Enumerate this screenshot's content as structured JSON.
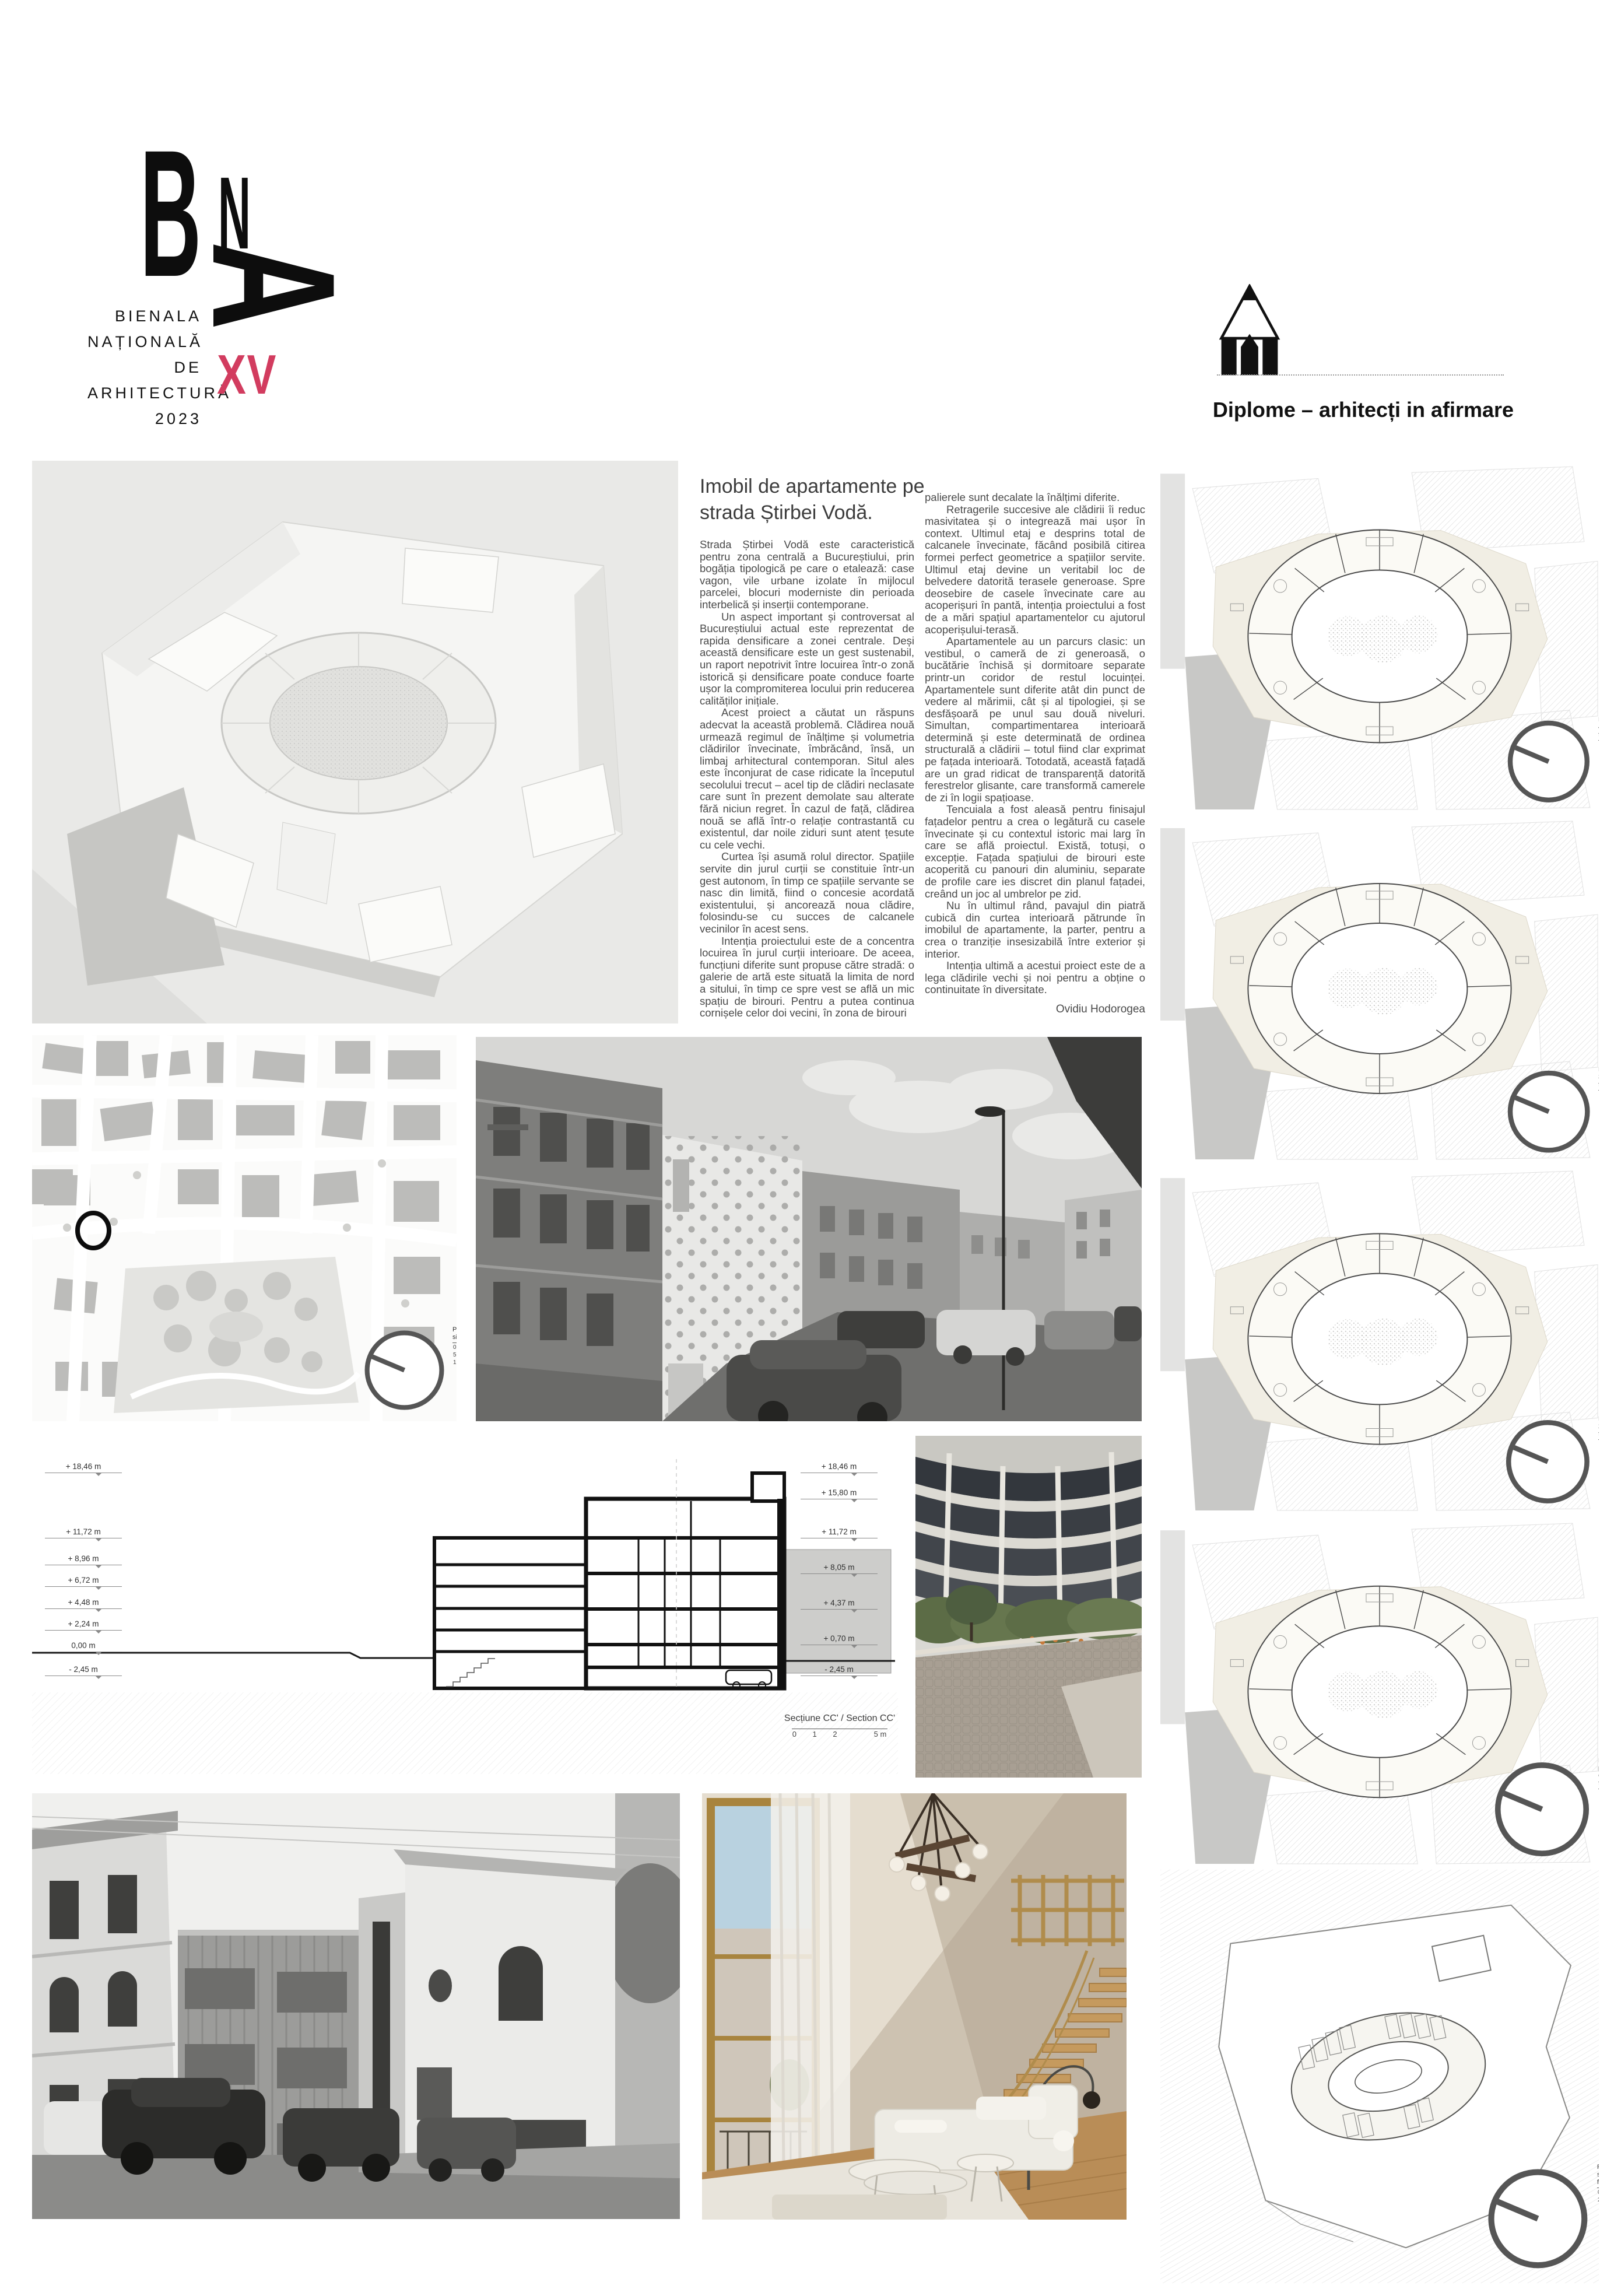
{
  "logo": {
    "letter_b": "B",
    "letter_n": "N",
    "letter_a": "A",
    "lines": [
      "BIENALA",
      "NAȚIONALĂ",
      "DE",
      "ARHITECTURĂ",
      "2023"
    ],
    "edition": "XV",
    "edition_color": "#d23c5f"
  },
  "category": {
    "label": "Diplome – arhitecți in afirmare",
    "icon": "pencil-icon"
  },
  "article": {
    "title": "Imobil de apartamente pe strada Știrbei Vodă.",
    "col1": [
      "Strada Știrbei Vodă este caracteristică pentru zona centrală a Bucureștiului, prin bogăția tipologică pe care o etalează: case vagon, vile urbane izolate în mijlocul parcelei, blocuri moderniste din perioada interbelică și inserții contemporane.",
      "Un aspect important și controversat al Bucureștiului actual este reprezentat de rapida densificare a zonei centrale. Deși această densificare este un gest sustenabil, un raport nepotrivit între locuirea într-o zonă istorică și densificare poate conduce foarte ușor la compromiterea locului prin reducerea calităților inițiale.",
      "Acest proiect a căutat un răspuns adecvat la această problemă. Clădirea nouă urmează regimul de înălțime și volumetria clădirilor învecinate, îmbrăcând, însă, un limbaj arhitectural contemporan. Situl ales este înconjurat de case ridicate la începutul secolului trecut – acel tip de clădiri neclasate care sunt în prezent demolate sau alterate fără niciun regret. În cazul de față, clădirea nouă se află într-o relație contrastantă cu existentul, dar noile ziduri sunt atent țesute cu cele vechi.",
      "Curtea își asumă rolul director. Spațiile servite din jurul curții se constituie într-un gest autonom, în timp ce spațiile servante se nasc din limită, fiind o concesie acordată existentului, și ancorează noua clădire, folosindu-se cu succes de calcanele vecinilor în acest sens.",
      "Intenția proiectului este de a concentra locuirea în jurul curții interioare. De aceea, funcțiuni diferite sunt propuse către stradă: o galerie de artă este situată la limita de nord a sitului, în timp ce spre vest se află un mic spațiu de birouri. Pentru a putea continua cornișele celor doi vecini, în zona de birouri"
    ],
    "col2": [
      "palierele sunt decalate la înălțimi diferite.",
      "Retragerile succesive ale clădirii îi reduc masivitatea și o integrează mai ușor în context. Ultimul etaj e desprins total de calcanele învecinate, făcând posibilă citirea formei perfect geometrice a spațiilor servite. Ultimul etaj devine un veritabil loc de belvedere datorită terasele generoase. Spre deosebire de casele învecinate care au acoperișuri în pantă, intenția proiectului a fost de a mări spațiul apartamentelor cu ajutorul acoperișului-terasă.",
      "Apartamentele au un parcurs clasic: un vestibul, o cameră de zi generoasă, o bucătărie închisă și dormitoare separate printr-un coridor de restul locuinței. Apartamentele sunt diferite atât din punct de vedere al mărimii, cât și al tipologiei, și se desfășoară pe unul sau două niveluri. Simultan, compartimentarea interioară determină și este determinată de ordinea structurală a clădirii – totul fiind clar exprimat pe fațada interioară. Totodată, această fațadă are un grad ridicat de transparență datorită ferestrelor glisante, care transformă camerele de zi în logii spațioase.",
      "Tencuiala a fost aleasă pentru finisajul fațadelor pentru a crea o legătură cu casele învecinate și cu contextul istoric mai larg în care se află proiectul. Există, totuși, o excepție. Fațada spațiului de birouri este acoperită cu panouri din aluminiu, separate de profile care ies discret din planul fațadei, creând un joc al umbrelor pe zid.",
      "Nu în ultimul rând, pavajul din piatră cubică din curtea interioară pătrunde în imobilul de apartamente, la parter, pentru a crea o tranziție insesizabilă între exterior și interior.",
      "Intenția ultimă a acestui proiect este de a lega clădirile vechi și noi pentru a obține o continuitate în diversitate."
    ],
    "author": "Ovidiu Hodorogea"
  },
  "section": {
    "caption": "Secțiune CC' / Section CC'",
    "scale_numbers": "0 1 2",
    "scale_end": "5 m",
    "levels_left": [
      "+ 18,46 m",
      "+ 11,72 m",
      "+ 8,96 m",
      "+ 6,72 m",
      "+ 4,48 m",
      "+ 2,24 m",
      "0,00 m",
      "- 2,45 m"
    ],
    "levels_right": [
      "+ 18,46 m",
      "+ 15,80 m",
      "+ 11,72 m",
      "+ 8,05 m",
      "+ 4,37 m",
      "+ 0,70 m",
      "- 2,45 m"
    ]
  },
  "site_plan": {
    "caption": "Plan de situație",
    "scale_numbers": "0 5 10",
    "scale_end": "25 m"
  },
  "floor_plans": [
    {
      "caption": "Plan etaj 4 / 4th floor plan",
      "scale_numbers": "0 1 2",
      "scale_end": "5 m"
    },
    {
      "caption": "Plan etaj 3 / 3rd floor plan",
      "scale_numbers": "0 1 2",
      "scale_end": "5 m"
    },
    {
      "caption": "Plan etaj 2 / 2nd floor plan",
      "scale_numbers": "0 1 2",
      "scale_end": "5 m"
    },
    {
      "caption": "Plan parter / Ground floor plan",
      "scale_numbers": "0 1 2",
      "scale_end": "5 m"
    },
    {
      "caption": "Plan subsol/Basement floor plan",
      "scale_numbers": "0 1 2",
      "scale_end": "5 m"
    }
  ]
}
